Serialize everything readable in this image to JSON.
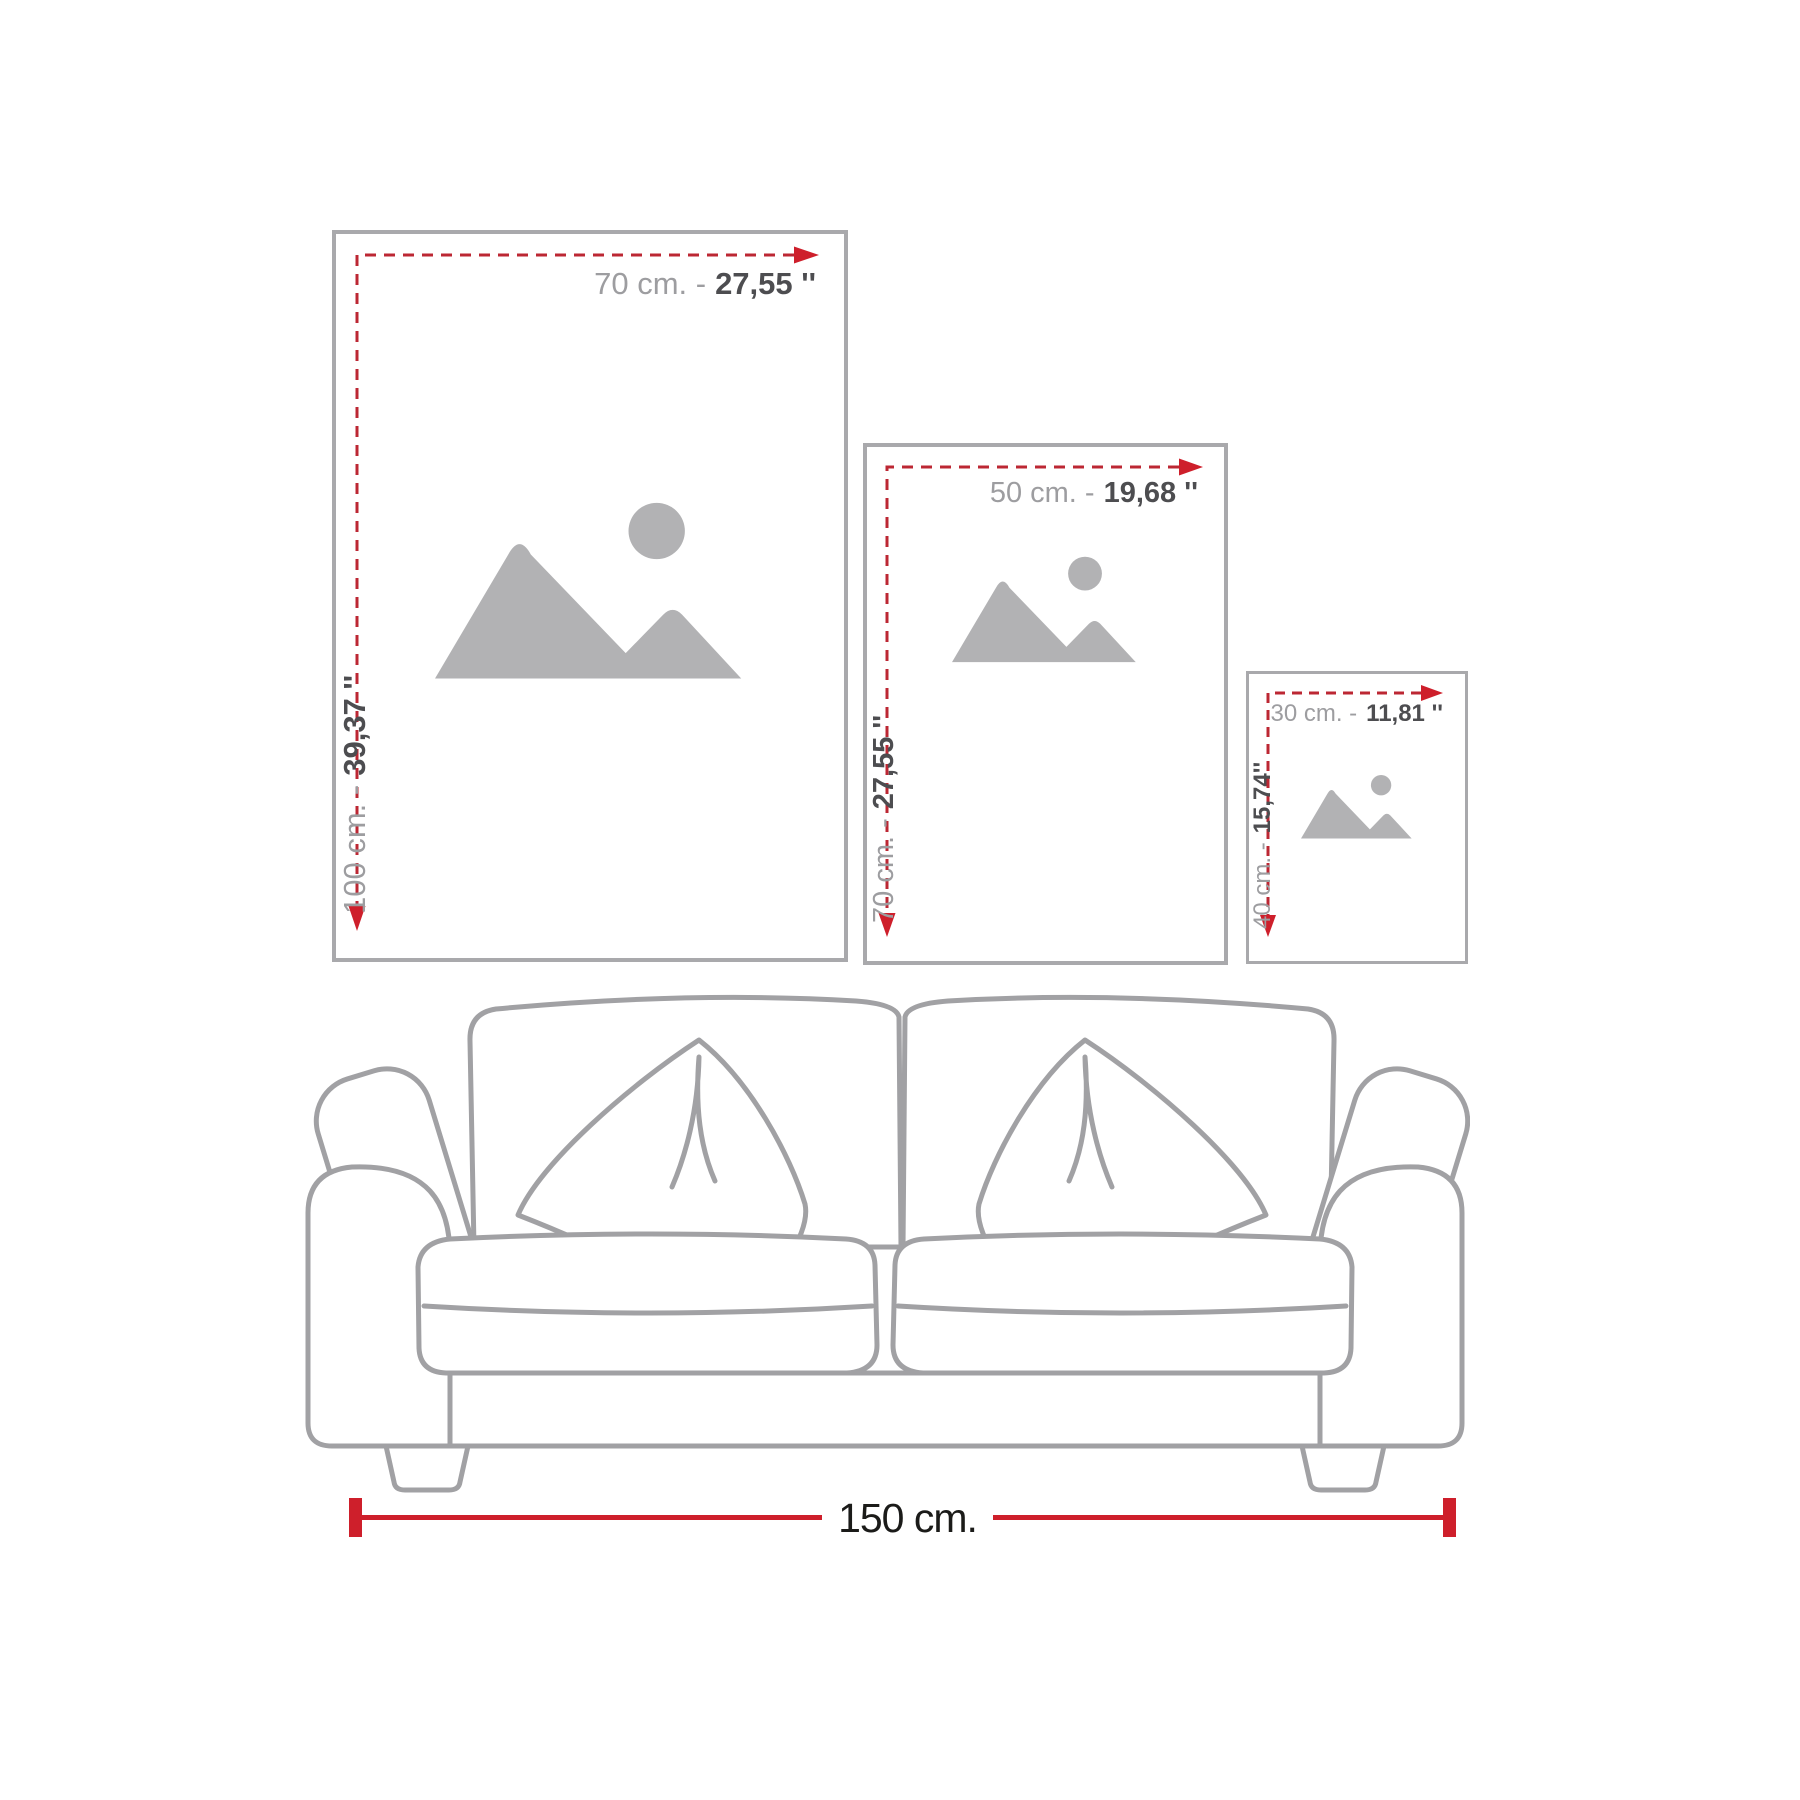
{
  "frames": [
    {
      "size_name": "large",
      "width_value": "70 cm. -",
      "width_inches": "27,55 ''",
      "height_value": "100 cm. -",
      "height_inches": "39,37 ''"
    },
    {
      "size_name": "medium",
      "width_value": "50 cm. -",
      "width_inches": "19,68 ''",
      "height_value": "70 cm. -",
      "height_inches": "27,55 ''"
    },
    {
      "size_name": "small",
      "width_value": "30 cm. -",
      "width_inches": "11,81 ''",
      "height_value": "40 cm. -",
      "height_inches": "15,74''"
    }
  ],
  "sofa": {
    "width_label": "150 cm."
  },
  "colors": {
    "measure_red": "#ce1f2b",
    "dash_red": "#bc2733",
    "frame_border": "#a9a9ac",
    "sofa_line": "#a1a1a4",
    "placeholder_gray": "#b2b2b4",
    "label_light": "#9d9da0",
    "label_dark": "#4d4d50",
    "bottom_label_dark": "#1b1b19"
  },
  "icons": {
    "placeholder": "image-placeholder-icon",
    "width_arrow": "arrow-right-icon",
    "height_arrow": "arrow-down-icon"
  }
}
